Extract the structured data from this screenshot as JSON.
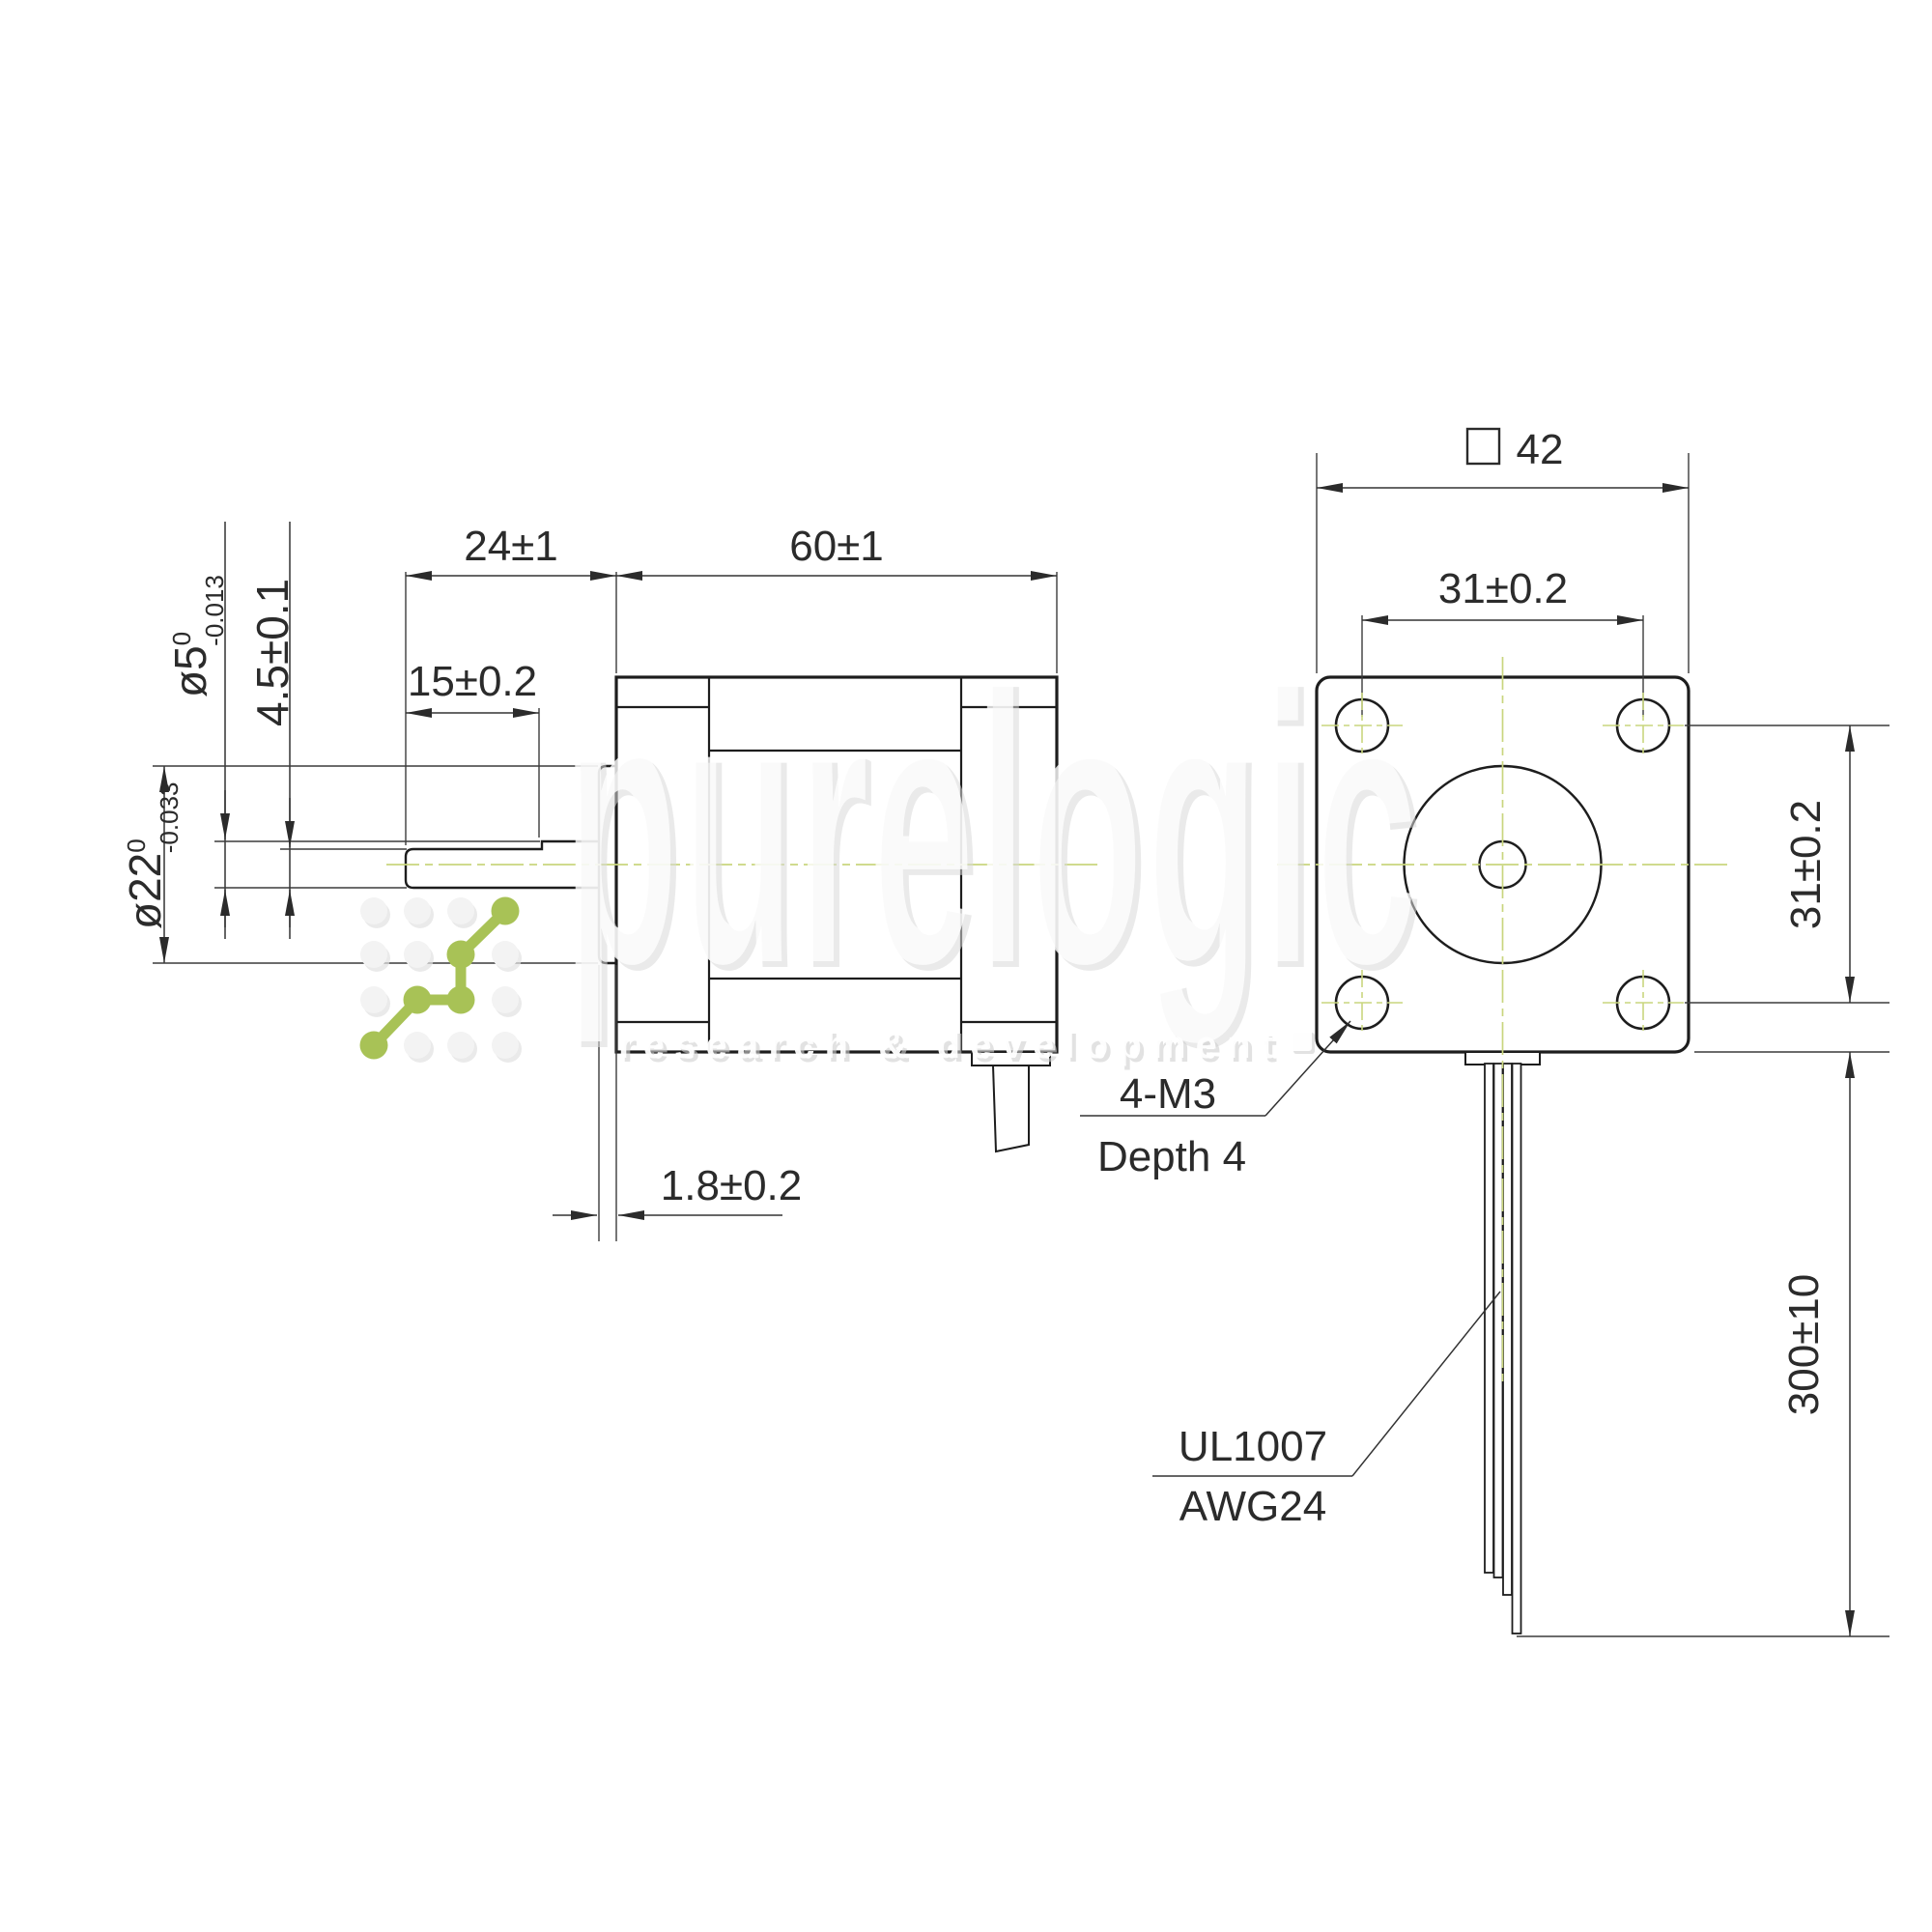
{
  "drawing": {
    "side_view": {
      "shaft_length": "24±1",
      "body_length": "60±1",
      "flat_length": "15±0.2",
      "flat_height": "4.5±0.1",
      "shaft_dia": "ø5",
      "shaft_dia_tol_upper": "0",
      "shaft_dia_tol_lower": "-0.013",
      "pilot_dia": "ø22",
      "pilot_dia_tol_upper": "0",
      "pilot_dia_tol_lower": "-0.033",
      "pilot_depth": "1.8±0.2"
    },
    "front_view": {
      "square_size": "42",
      "hole_spacing_horizontal": "31±0.2",
      "hole_spacing_vertical": "31±0.2",
      "wire_length": "300±10",
      "mount_holes_label_line1": "4-M3",
      "mount_holes_label_line2": "Depth 4",
      "wire_label_line1": "UL1007",
      "wire_label_line2": "AWG24"
    },
    "watermark": {
      "brand": "purelogic",
      "tagline": "research & development"
    },
    "colors": {
      "centerline": "#c9d67e",
      "logo_green": "#a8c256",
      "line": "#1d1d1d"
    }
  }
}
